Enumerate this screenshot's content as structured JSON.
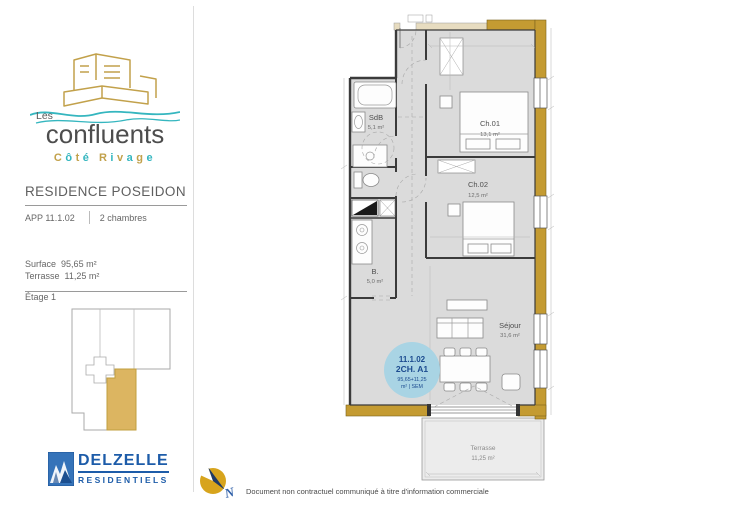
{
  "branding": {
    "name_small": "Les",
    "name_large": "confluents",
    "tagline": "Côté Rivage",
    "gold": "#C2A14B",
    "teal": "#35B6BF"
  },
  "project": {
    "residence": "RESIDENCE POSEIDON",
    "apartment": "APP 11.1.02",
    "rooms_label": "2 chambres",
    "surface_label": "Surface",
    "surface_value": "95,65 m²",
    "terrace_label": "Terrasse",
    "terrace_value": "11,25 m²",
    "floor_label": "Étage 1"
  },
  "plan": {
    "rooms": [
      {
        "name": "SdB",
        "area": "5,1 m²"
      },
      {
        "name": "Ch.01",
        "area": "13,1 m²"
      },
      {
        "name": "Ch.02",
        "area": "12,5 m²"
      },
      {
        "name": "B.",
        "area": "5,0 m²"
      },
      {
        "name": "Séjour",
        "area": "31,6 m²"
      },
      {
        "name": "Terrasse",
        "area": "11,25 m²"
      }
    ],
    "badge": {
      "line1": "11.1.02",
      "line2": "2CH. A1",
      "line3": "95,65+11,25",
      "line4": "m² | SEM",
      "bg": "#A9D4E4",
      "fg": "#1C4B8F"
    }
  },
  "developer": {
    "name": "DELZELLE",
    "subtitle": "RESIDENTIELS",
    "blue": "#1D5CA9"
  },
  "compass": {
    "label": "N"
  },
  "footer": {
    "disclaimer": "Document non contractuel communiqué à titre d'information commerciale"
  }
}
